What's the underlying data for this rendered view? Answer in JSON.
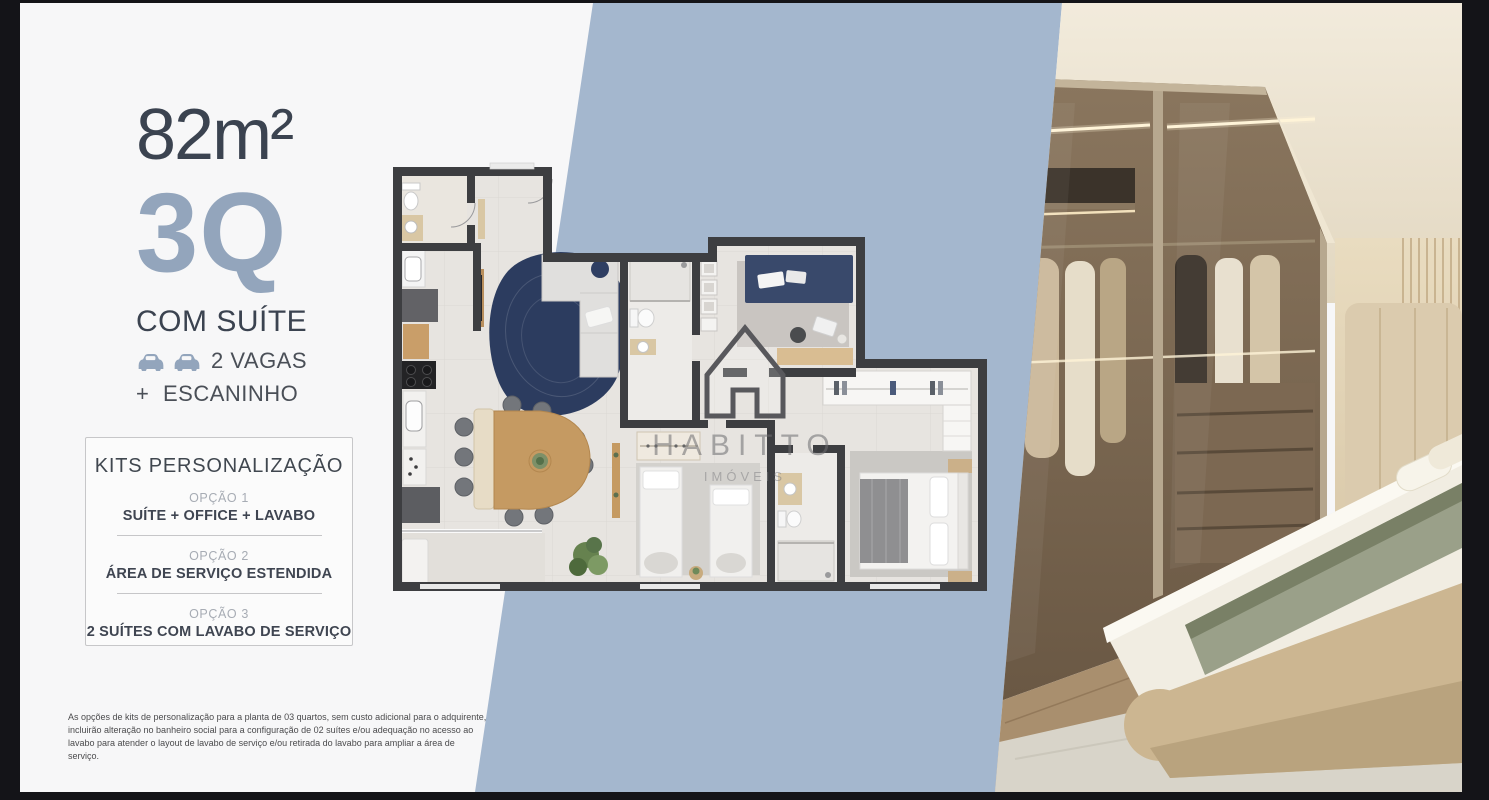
{
  "unit": {
    "area": "82m²",
    "type": "3Q",
    "suite_label": "COM SUÍTE",
    "parking_label": "2 VAGAS",
    "extra_plus": "+",
    "extra_label": "ESCANINHO"
  },
  "kits": {
    "title": "KITS PERSONALIZAÇÃO",
    "options": [
      {
        "label": "OPÇÃO 1",
        "value": "SUÍTE + OFFICE + LAVABO"
      },
      {
        "label": "OPÇÃO 2",
        "value": "ÁREA DE SERVIÇO ESTENDIDA"
      },
      {
        "label": "OPÇÃO 3",
        "value": "2 SUÍTES COM LAVABO DE SERVIÇO"
      }
    ]
  },
  "disclaimer": {
    "text": "As opções de kits de personalização para a planta de 03 quartos, sem custo adicional para o adquirente, incluirão alteração no banheiro social para a configuração de 02 suítes e/ou adequação no acesso ao lavabo para atender o layout de lavabo de serviço e/ou retirada do lavabo para ampliar a área de serviço."
  },
  "watermark": {
    "brand": "HABITTO",
    "subtitle": "IMÓVEIS"
  },
  "icons": {
    "parking": "car-icon",
    "watermark_house": "house-icon"
  },
  "colors": {
    "canvas": "#f7f7f8",
    "frame": "#141418",
    "diagonal_band": "#a4b7ce",
    "accent_dark": "#3b4350",
    "accent_muted": "#93a5bc",
    "walls": "#3d3e41",
    "rug": "#2c3c5f",
    "wood": "#c59a62"
  }
}
